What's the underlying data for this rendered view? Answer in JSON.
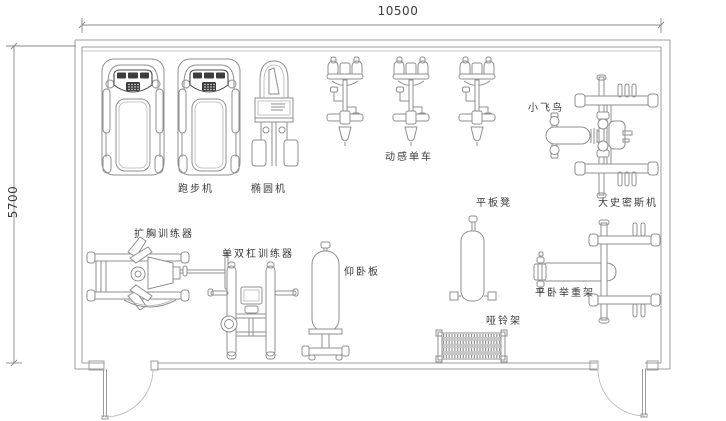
{
  "page": {
    "background": "#ffffff",
    "type": "gym-floor-plan"
  },
  "dimensions": {
    "width_label": "10500",
    "height_label": "5700"
  },
  "equipment": [
    {
      "id": "treadmill",
      "label": "跑步机",
      "count": 2
    },
    {
      "id": "elliptical",
      "label": "椭圆机",
      "count": 1
    },
    {
      "id": "spin-bike",
      "label": "动感单车",
      "count": 3
    },
    {
      "id": "fly-bird",
      "label": "小飞鸟",
      "count": 1
    },
    {
      "id": "smith-machine",
      "label": "大史密斯机",
      "count": 1
    },
    {
      "id": "chest-expander",
      "label": "扩胸训练器",
      "count": 1
    },
    {
      "id": "dip-station",
      "label": "单双杠训练器",
      "count": 1
    },
    {
      "id": "situp-board",
      "label": "仰卧板",
      "count": 1
    },
    {
      "id": "flat-bench",
      "label": "平板凳",
      "count": 1
    },
    {
      "id": "bench-press-rack",
      "label": "平卧举重架",
      "count": 1
    },
    {
      "id": "dumbbell-rack",
      "label": "哑铃架",
      "count": 1
    }
  ],
  "colors": {
    "wall_line": "#9d9d9d",
    "equipment_line": "#8f8f8f",
    "dark_detail": "#3d3d3d",
    "text": "#3a3a3a"
  }
}
